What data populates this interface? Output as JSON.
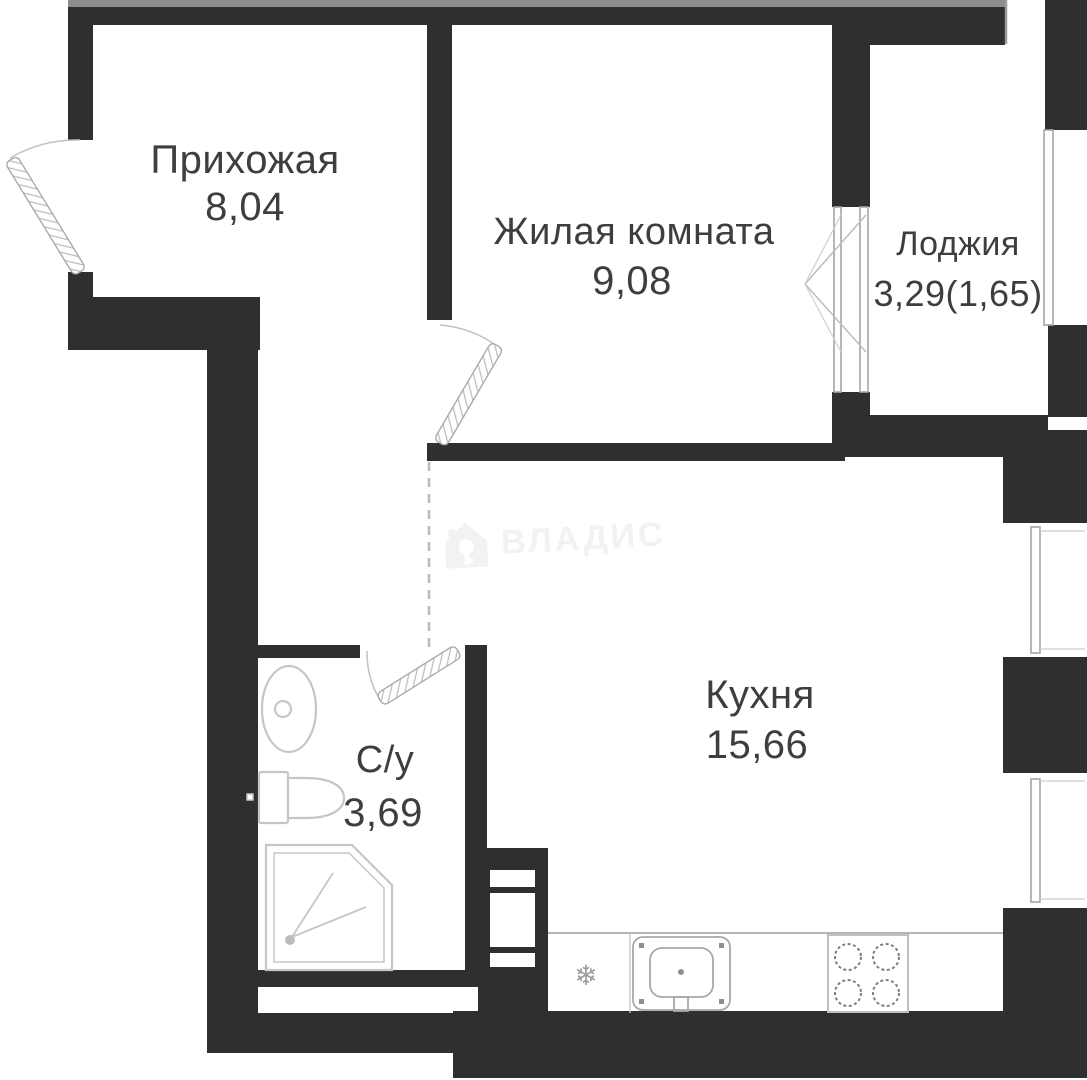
{
  "plan": {
    "rooms": [
      {
        "id": "hallway",
        "label": "Прихожая",
        "area": "8,04"
      },
      {
        "id": "living-room",
        "label": "Жилая комната",
        "area": "9,08"
      },
      {
        "id": "loggia",
        "label": "Лоджия",
        "area": "3,29(1,65)"
      },
      {
        "id": "kitchen",
        "label": "Кухня",
        "area": "15,66"
      },
      {
        "id": "bathroom",
        "label": "С/у",
        "area": "3,69"
      }
    ],
    "watermark": {
      "text": "ВЛАДИС",
      "icon": "house-key-icon",
      "color": "#f2f2f2"
    },
    "icons": [
      "house-key-icon",
      "snowflake-fridge-icon"
    ],
    "colors": {
      "wall": "#2f2f31",
      "top_strip": "#8d8d8d",
      "text": "#3e3e40",
      "fixture_stroke": "#c6c6c6",
      "counter_stroke": "#b5b5b5",
      "watermark": "#f2f2f2"
    }
  }
}
